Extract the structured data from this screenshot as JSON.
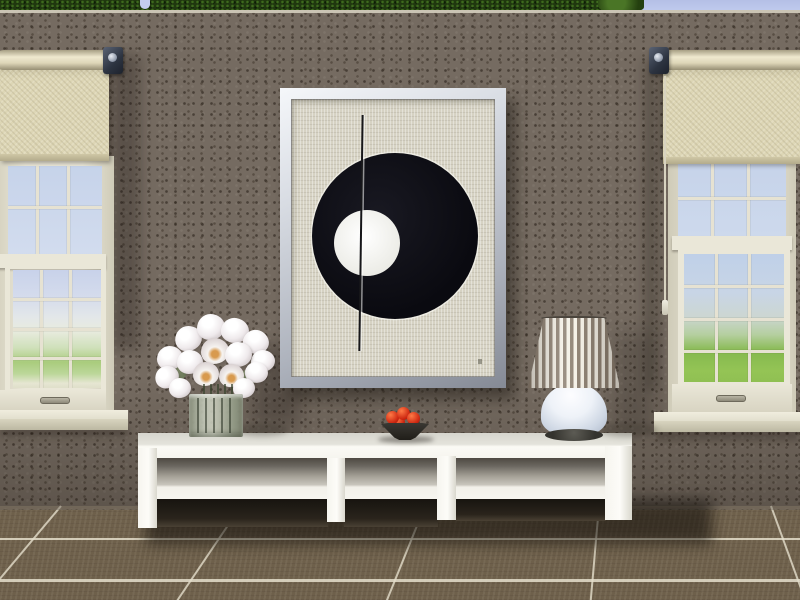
{
  "scene_type": "life-simulation game interior screenshot, no HUD or text visible",
  "colors": {
    "sky": "#c3cdef",
    "hedge": "#20380f",
    "hedge_light": "#3e6a1e",
    "wall_base": "#756b61",
    "wall_edge": "#d9d3c3",
    "floor_base": "#6e604b",
    "grout": "#e5dfcc",
    "blind_fabric": "#ddd6b5",
    "blind_bar": "#cfc7a6",
    "win_frame": "#eae7d8",
    "win_frame_sh": "#cfcbb8",
    "muntin": "#e6e2d2",
    "pane_sky": "#c6d3ea",
    "sill_front": "#d8d4bf",
    "art_canvas": "#d6d2c3",
    "art_black": "#0a0a10",
    "art_white": "#ebebe5",
    "table_white": "#f6f5ef",
    "shelf_top": "#a39f95",
    "void_dark": "#17140f",
    "tulip_hi": "#efeaec",
    "tulip_lo": "#a9a1a3",
    "leaf_green": "#5f6e4e",
    "bowl_dark": "#201e19",
    "fruit_red": "#cd2711",
    "lamp_stripe": "#8b7e70",
    "lamp_cream": "#f4f0e6",
    "lamp_base_hi": "#fdfdff",
    "lamp_base_lo": "#aab4c5",
    "lamp_foot": "#34332e"
  },
  "objects": {
    "hedge": {
      "label": "Hedge above wall"
    },
    "sky": {
      "label": "Sky"
    },
    "wall": {
      "label": "Taupe textured wall"
    },
    "floor": {
      "label": "Brown tile floor with light grout"
    },
    "left_blind": {
      "label": "Cream roller blind, half open"
    },
    "left_window": {
      "label": "White sash window with grid panes"
    },
    "right_blind": {
      "label": "Cream roller blind with pull cord"
    },
    "right_window": {
      "label": "White sash window with grid panes"
    },
    "artwork": {
      "label": "Framed print: black circle with white circle and vertical line"
    },
    "console_table": {
      "label": "Low white console table with shelf"
    },
    "tulip_vase": {
      "label": "White tulips in square glass vase"
    },
    "fruit_bowl": {
      "label": "Dark bowl with red fruit"
    },
    "table_lamp": {
      "label": "Table lamp with striped shade"
    }
  }
}
